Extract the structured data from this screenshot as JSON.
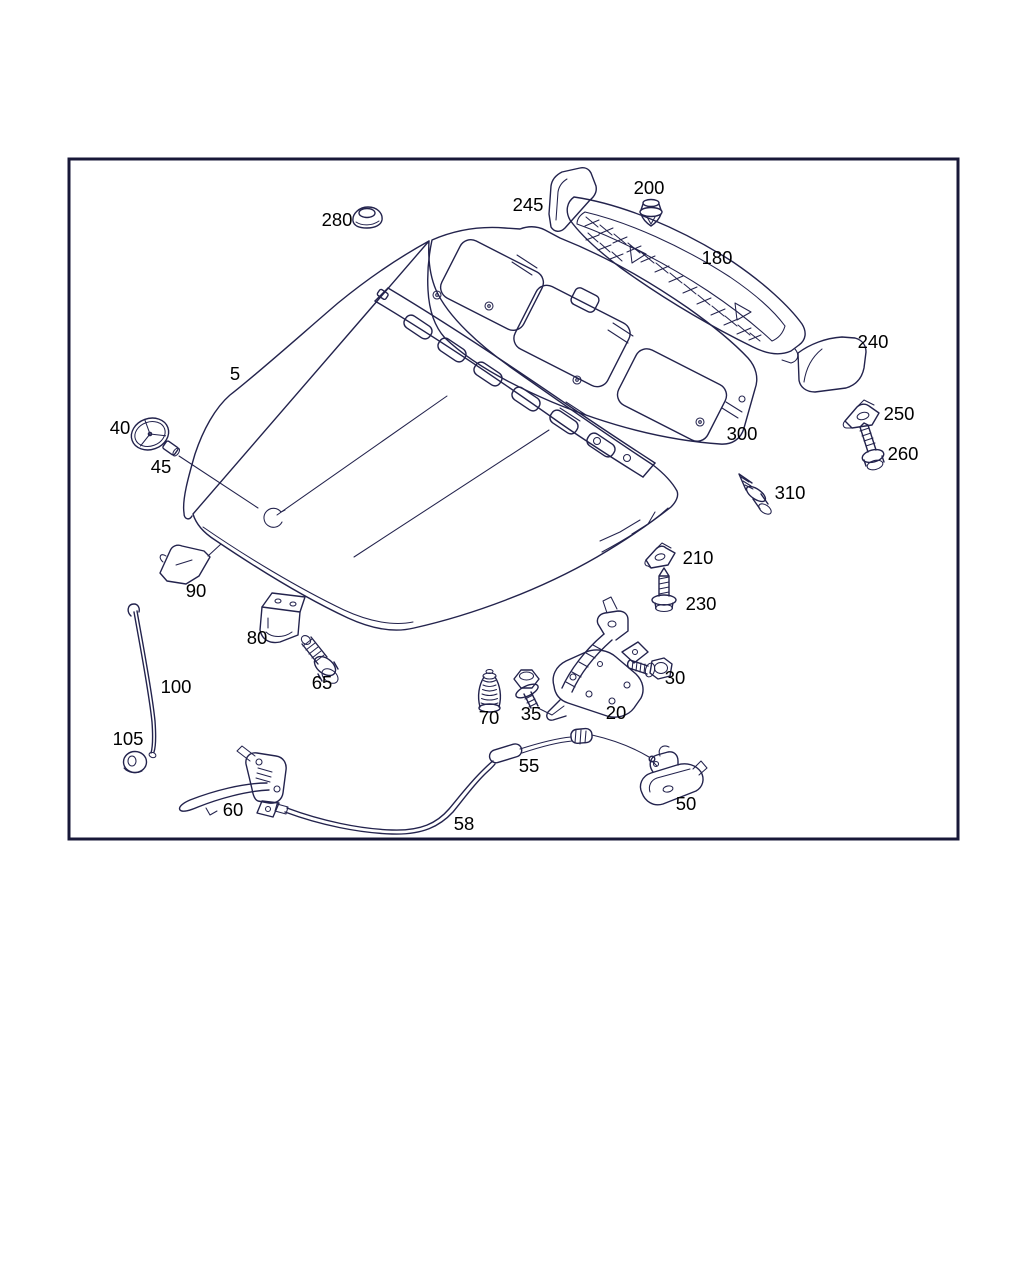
{
  "colors": {
    "background": "#ffffff",
    "frame_border": "#181838",
    "line_art": "#23234d",
    "label_text": "#000000"
  },
  "parts": [
    {
      "number": "5"
    },
    {
      "number": "20"
    },
    {
      "number": "30"
    },
    {
      "number": "35"
    },
    {
      "number": "40"
    },
    {
      "number": "45"
    },
    {
      "number": "50"
    },
    {
      "number": "55"
    },
    {
      "number": "58"
    },
    {
      "number": "60"
    },
    {
      "number": "65"
    },
    {
      "number": "70"
    },
    {
      "number": "80"
    },
    {
      "number": "90"
    },
    {
      "number": "100"
    },
    {
      "number": "105"
    },
    {
      "number": "180"
    },
    {
      "number": "200"
    },
    {
      "number": "210"
    },
    {
      "number": "230"
    },
    {
      "number": "240"
    },
    {
      "number": "245"
    },
    {
      "number": "250"
    },
    {
      "number": "260"
    },
    {
      "number": "280"
    },
    {
      "number": "300"
    },
    {
      "number": "310"
    }
  ]
}
